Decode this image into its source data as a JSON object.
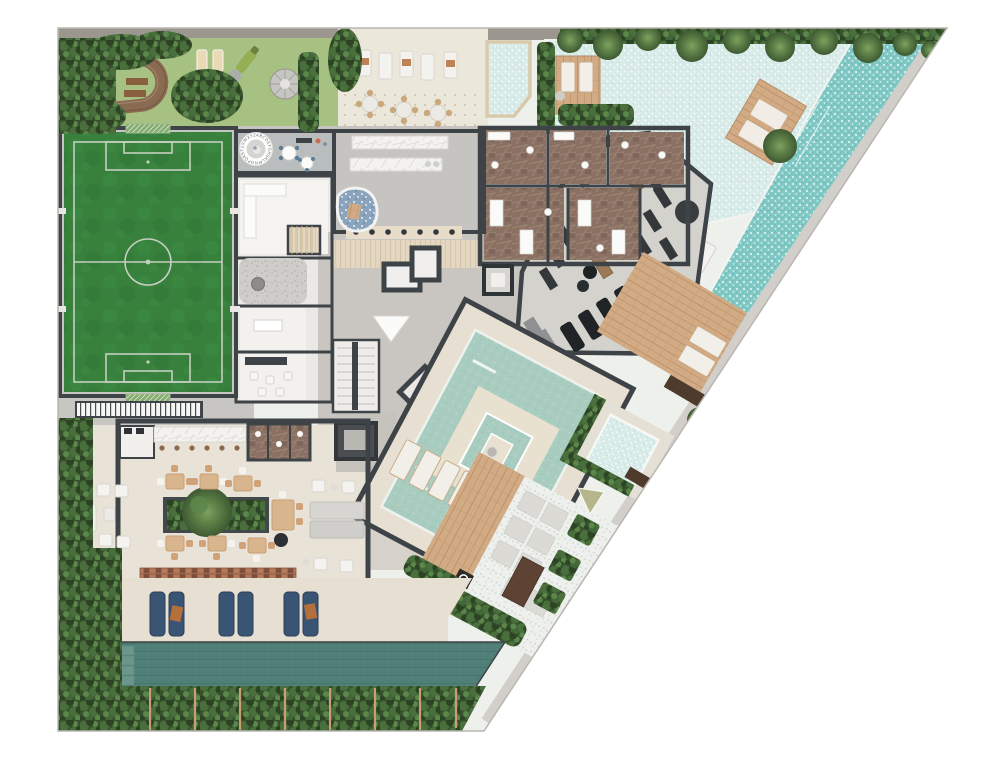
{
  "plan": {
    "kind": "residential amenities floor plan, top-down 3D render",
    "alphabet_circle_letters": "ABCDEFGHIJKLMNOPQRSTUVWXYZ",
    "areas": [
      {
        "id": "kids-playground",
        "label": "Kids playground with running track"
      },
      {
        "id": "soccer-field",
        "label": "Soccer field"
      },
      {
        "id": "playroom",
        "label": "Kids playroom with alphabet circle"
      },
      {
        "id": "terrace-lounge",
        "label": "Terrace with sun loungers and tables"
      },
      {
        "id": "bar",
        "label": "Bar with marble counters"
      },
      {
        "id": "locker-rooms",
        "label": "Locker rooms and restrooms"
      },
      {
        "id": "gym",
        "label": "Fitness center"
      },
      {
        "id": "lagoon-pool",
        "label": "Lagoon pool with island deck"
      },
      {
        "id": "east-lap-pool",
        "label": "Lap pool along the diagonal edge"
      },
      {
        "id": "wood-deck",
        "label": "Wood sun deck"
      },
      {
        "id": "spa-pool",
        "label": "Spa plunge pool"
      },
      {
        "id": "covered-pool",
        "label": "Covered pool with island lounge"
      },
      {
        "id": "zen-garden",
        "label": "Zen garden with pavers and planters"
      },
      {
        "id": "party-room",
        "label": "Gourmet party room"
      },
      {
        "id": "south-sun-deck",
        "label": "South sun deck with loungers"
      },
      {
        "id": "south-lap-pool",
        "label": "South lap pool"
      },
      {
        "id": "perimeter-hedge",
        "label": "Perimeter hedge, fence and palm trees"
      },
      {
        "id": "core",
        "label": "Elevator core, stairs and corridors"
      }
    ],
    "palette": {
      "lawn": "#a7c183",
      "field_green": "#37813d",
      "field_line": "#c5cfc0",
      "track_brown": "#8a6b52",
      "hedge_green": "#36512c",
      "palm_green": "#4f6f41",
      "lagoon_shallow": "#d8ebe8",
      "pool_deep": "#82c9c6",
      "pool_sage": "#a8ccbf",
      "spa_pool": "#c8e6e0",
      "lap_pool_south": "#4f7f76",
      "water_feature_pebble": "#8aa4bd",
      "terrace_floor": "#ece7db",
      "party_floor": "#e9e3d7",
      "corridor_gray": "#c9c6c2",
      "gym_floor": "#d3d2cc",
      "marble_brown": "#8b7163",
      "marble_white": "#f3f2ef",
      "wood_deck": "#d2ab85",
      "wall_dark": "#3e4347",
      "walkway": "#d2cfca",
      "outdoor_pale": "#eef0ec",
      "lounger_navy": "#3a5474",
      "brick_wall": "#a06a50",
      "fence_post": "#c89e74"
    }
  }
}
